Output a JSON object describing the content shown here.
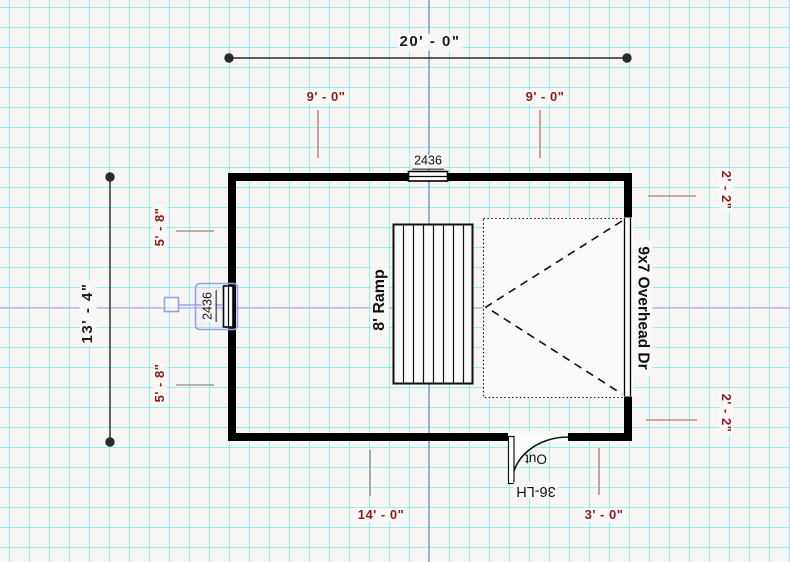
{
  "app": {
    "view": "floor-plan-drawing",
    "palette": {
      "background": "#f8f6f5",
      "grid_line": "#46e8e8",
      "wall": "#000000",
      "dimension_text": "#1c1c1c",
      "sub_dimension_text": "#8b1d1d",
      "leader_line": "#b39191",
      "selection_accent": "#96a4e6",
      "construction_vertical": "#7e89ab",
      "construction_horizontal": "#ceadd1"
    }
  },
  "dimensions": {
    "overall_width": "20' - 0\"",
    "overall_height": "13' - 4\"",
    "top_left_span": "9' - 0\"",
    "top_right_span": "9' - 0\"",
    "left_upper_span": "5' - 8\"",
    "left_lower_span": "5' - 8\"",
    "right_upper_span": "2' - 2\"",
    "right_lower_span": "2' - 2\"",
    "bottom_left_span": "14' - 0\"",
    "bottom_right_span": "3' - 0\""
  },
  "fixtures": {
    "top_window_size": "2436",
    "left_window_size": "2436",
    "ramp_label": "8' Ramp",
    "overhead_door_label": "9x7 Overhead Dr",
    "entry_door_swing_label": "Out",
    "entry_door_size": "36-LH"
  }
}
